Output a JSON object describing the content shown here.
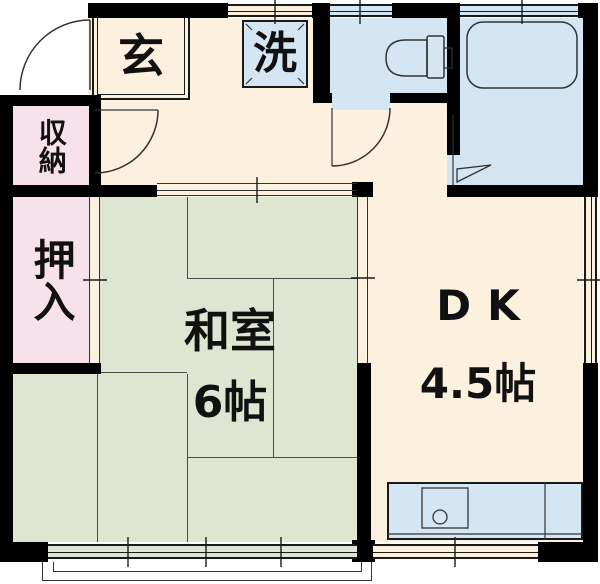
{
  "plan": {
    "type": "apartment-floor-plan",
    "rooms": {
      "genkan": {
        "label": "玄"
      },
      "laundry": {
        "label": "洗"
      },
      "storage": {
        "label": "収納"
      },
      "closet": {
        "label": "押入"
      },
      "tatami_room": {
        "label": "和室",
        "size": "6帖"
      },
      "dining_kitchen": {
        "label": "DK",
        "size": "4.5帖"
      }
    },
    "fixtures": {
      "toilet": "toilet-fixture",
      "bathtub": "bathtub-fixture",
      "kitchen_sink": "kitchen-sink-fixture",
      "washer_pan": "washing-machine-pan",
      "balcony": "balcony-outline"
    },
    "colors": {
      "wall": "#000000",
      "floor": "#fbf1de",
      "tatami": "#dee6d2",
      "closet": "#f7e1ea",
      "wet_area": "#d4e6f4",
      "line": "#333333",
      "text": "#111111"
    }
  }
}
